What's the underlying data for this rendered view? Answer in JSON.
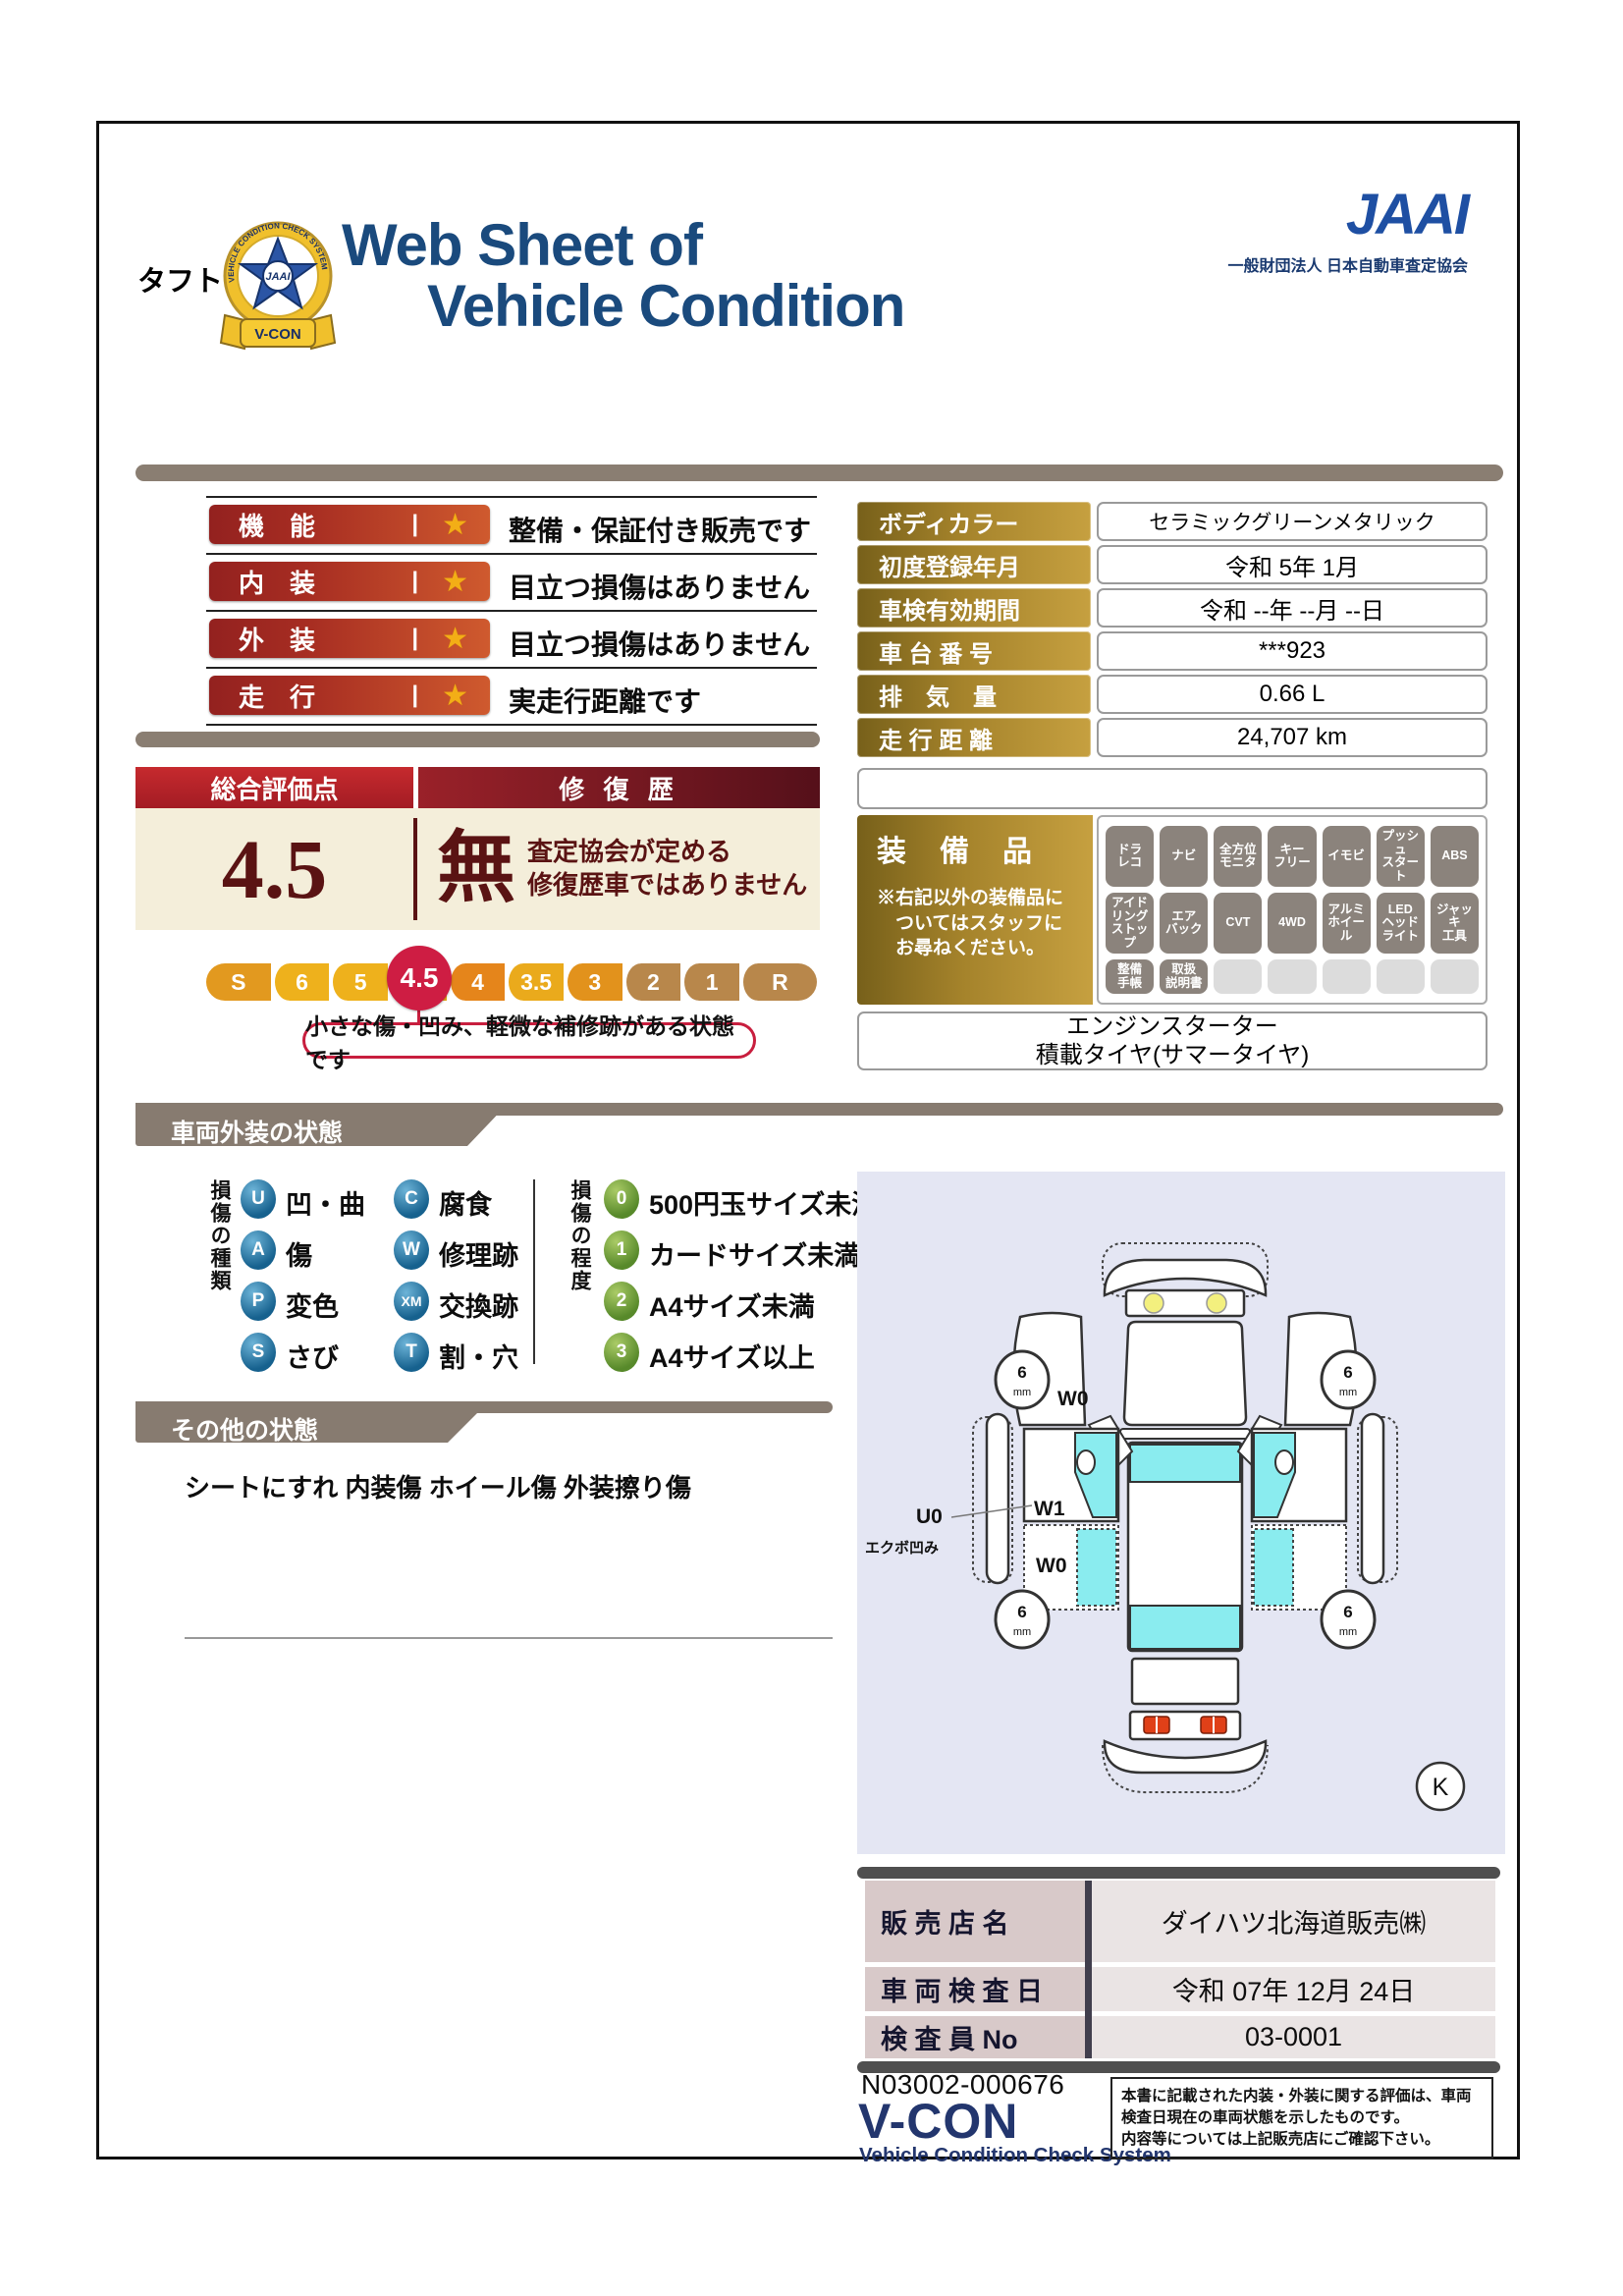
{
  "header": {
    "badge_ribbon": "V-CON",
    "badge_ring_text": "VEHICLE CONDITION CHECK SYSTEM",
    "badge_center": "JAAI",
    "title_line1": "Web Sheet of",
    "title_line2": "Vehicle Condition",
    "jaai_logo": "JAAI",
    "jaai_subtitle": "一般財団法人 日本自動車査定協会"
  },
  "vehicle_name": "タフト",
  "ratings": [
    {
      "label": "機　能",
      "bar": "|",
      "star": "★",
      "description": "整備・保証付き販売です"
    },
    {
      "label": "内　装",
      "bar": "|",
      "star": "★",
      "description": "目立つ損傷はありません"
    },
    {
      "label": "外　装",
      "bar": "|",
      "star": "★",
      "description": "目立つ損傷はありません"
    },
    {
      "label": "走　行",
      "bar": "|",
      "star": "★",
      "description": "実走行距離です"
    }
  ],
  "overall": {
    "header_left": "総合評価点",
    "header_right": "修 復 歴",
    "score": "4.5",
    "repair": "無",
    "repair_note_line1": "査定協会が定める",
    "repair_note_line2": "修復歴車ではありません",
    "scale": [
      {
        "label": "S",
        "color": "#e2991f"
      },
      {
        "label": "6",
        "color": "#eeb11c"
      },
      {
        "label": "5",
        "color": "#eeb11c"
      },
      {
        "label": "4.5",
        "color": "#e8a71c"
      },
      {
        "label": "4",
        "color": "#e5851b"
      },
      {
        "label": "3.5",
        "color": "#eaaa1c"
      },
      {
        "label": "3",
        "color": "#e2921c"
      },
      {
        "label": "2",
        "color": "#b8874b"
      },
      {
        "label": "1",
        "color": "#b8874b"
      },
      {
        "label": "R",
        "color": "#b8874b"
      }
    ],
    "scale_current": "4.5",
    "scale_current_color": "#ce1d43",
    "callout": "小さな傷・凹み、軽微な補修跡がある状態です"
  },
  "details": {
    "rows": [
      {
        "label": "ボディカラー",
        "value": "セラミックグリーンメタリック"
      },
      {
        "label": "初度登録年月",
        "value": "令和 5年 1月"
      },
      {
        "label": "車検有効期間",
        "value": "令和 --年 --月 --日"
      },
      {
        "label": "車 台 番 号",
        "value": "***923"
      },
      {
        "label": "排　気　量",
        "value": "0.66 L"
      },
      {
        "label": "走 行 距 離",
        "value": "24,707 km"
      }
    ]
  },
  "equipment": {
    "title": "装　備　品",
    "note_line1": "※右記以外の装備品に",
    "note_line2": "　ついてはスタッフに",
    "note_line3": "　お尋ねください。",
    "badges": [
      "ドラ\nレコ",
      "ナビ",
      "全方位\nモニタ",
      "キー\nフリー",
      "イモビ",
      "プッシュ\nスタート",
      "ABS",
      "アイド\nリング\nストップ",
      "エア\nバック",
      "CVT",
      "4WD",
      "アルミ\nホイール",
      "LED\nヘッド\nライト",
      "ジャッキ\n工具",
      "整備\n手帳",
      "取扱\n説明書",
      "",
      "",
      "",
      "",
      ""
    ],
    "extra_line1": "エンジンスターター",
    "extra_line2": "積載タイヤ(サマータイヤ)"
  },
  "exterior": {
    "section_title": "車両外装の状態",
    "type_group_label": "損傷の種類",
    "types": [
      {
        "code": "U",
        "text": "凹・曲"
      },
      {
        "code": "A",
        "text": "傷"
      },
      {
        "code": "P",
        "text": "変色"
      },
      {
        "code": "S",
        "text": "さび"
      },
      {
        "code": "C",
        "text": "腐食"
      },
      {
        "code": "W",
        "text": "修理跡"
      },
      {
        "code": "XM",
        "text": "交換跡"
      },
      {
        "code": "T",
        "text": "割・穴"
      }
    ],
    "degree_group_label": "損傷の程度",
    "degrees": [
      {
        "code": "0",
        "text": "500円玉サイズ未満"
      },
      {
        "code": "1",
        "text": "カードサイズ未満"
      },
      {
        "code": "2",
        "text": "A4サイズ未満"
      },
      {
        "code": "3",
        "text": "A4サイズ以上"
      }
    ]
  },
  "other": {
    "section_title": "その他の状態",
    "text": "シートにすれ 内装傷 ホイール傷 外装擦り傷"
  },
  "diagram": {
    "tire_value": "6",
    "tire_unit": "mm",
    "labels": {
      "front_door": "W0",
      "mid_door": "W1",
      "dent": "U0",
      "dent_note": "エクボ凹み",
      "rear_door": "W0",
      "corner_mark": "K"
    },
    "colors": {
      "background": "#e4e6f3",
      "glass": "#8aecef",
      "headlight": "#f3f07e",
      "taillight": "#e04018"
    }
  },
  "sales": {
    "rows": [
      {
        "label": "販 売 店 名",
        "value": "ダイハツ北海道販売㈱"
      },
      {
        "label": "車 両 検 査 日",
        "value": "令和 07年 12月 24日"
      },
      {
        "label": "検 査 員 No",
        "value": "03-0001"
      }
    ]
  },
  "footer": {
    "document_no": "N03002-000676",
    "vcon_logo": "V-CON",
    "vcon_subtitle": "Vehicle Condition Check System",
    "note_line1": "本書に記載された内装・外装に関する評価は、車両",
    "note_line2": "検査日現在の車両状態を示したものです。",
    "note_line3": "内容等については上記販売店にご確認下さい。"
  },
  "colors": {
    "navy_title": "#1a4a7d",
    "jaai_blue": "#1e4fa3",
    "section_brown": "#8a7e72",
    "rating_red_dark": "#93211f",
    "rating_red_light": "#cf5a2e",
    "gold_dark": "#77601a",
    "gold_light": "#c6a040",
    "maroon": "#5a1313",
    "cream": "#f4eeda",
    "crimson": "#c81e3e",
    "badge_gray": "#8b837c",
    "sales_label_pink": "#d8c9c9"
  }
}
